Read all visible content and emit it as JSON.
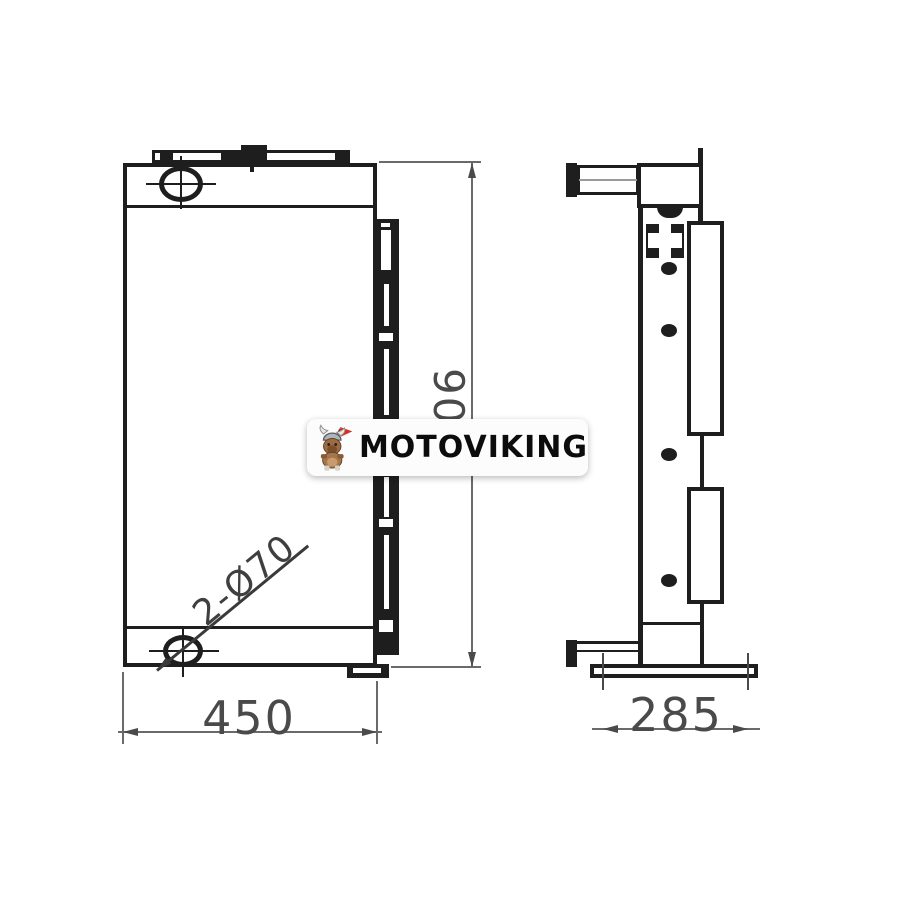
{
  "page": {
    "background": "#ffffff",
    "description": "technical drawing of hydraulic oil cooler, two orthographic views"
  },
  "drawing": {
    "views": {
      "front": {
        "name": "front-view",
        "label_width": "450",
        "label_height": "90",
        "port_callout": "2-Ø70"
      },
      "side": {
        "name": "side-view",
        "label_depth": "285"
      }
    },
    "colors": {
      "line": "#1e1e1e",
      "dimension": "#4a4a4a"
    }
  },
  "watermark": {
    "brand": "MOTOVIKING",
    "mascot": "viking-dog-with-red-flag",
    "badge_bg": "#fcfcfc",
    "text_color": "#0c0c0c",
    "flag_color": "#d93025"
  }
}
